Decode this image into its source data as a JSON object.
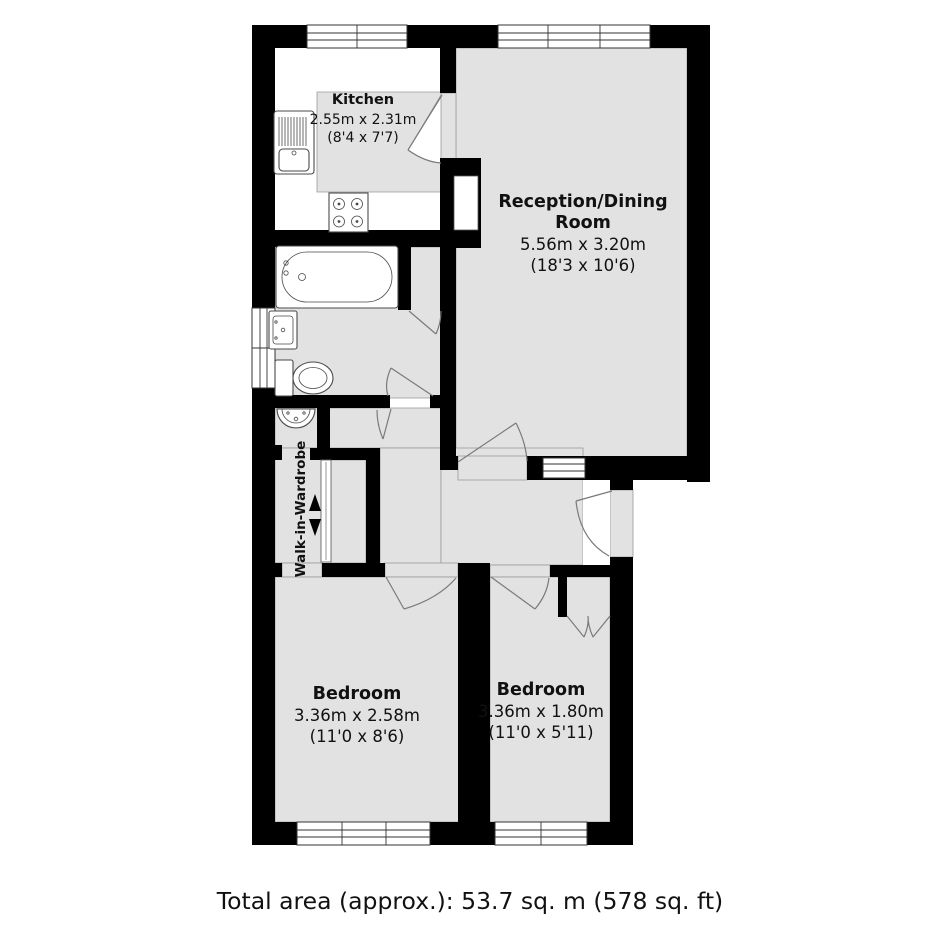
{
  "floorplan": {
    "kitchen": {
      "name": "Kitchen",
      "metric": "2.55m x 2.31m",
      "imperial": "(8'4 x 7'7)"
    },
    "reception": {
      "name_line1": "Reception/Dining",
      "name_line2": "Room",
      "metric": "5.56m x 3.20m",
      "imperial": "(18'3 x 10'6)"
    },
    "walk_in_wardrobe": {
      "name": "Walk-in-Wardrobe"
    },
    "bedroom_left": {
      "name": "Bedroom",
      "metric": "3.36m x 2.58m",
      "imperial": "(11'0 x 8'6)"
    },
    "bedroom_right": {
      "name": "Bedroom",
      "metric": "3.36m x 1.80m",
      "imperial": "(11'0 x 5'11)"
    },
    "footer": {
      "total_area": "Total area (approx.): 53.7 sq. m (578 sq. ft)"
    },
    "colors": {
      "wall": "#000000",
      "floor": "#e2e2e2",
      "fixture_outline": "#4a4a4a",
      "door_line": "#7a7a7a"
    },
    "fixtures": [
      "kitchen-sink-drainer",
      "hob",
      "bathtub",
      "wash-basin",
      "toilet",
      "hand-basin",
      "sliding-wardrobe-door"
    ]
  }
}
